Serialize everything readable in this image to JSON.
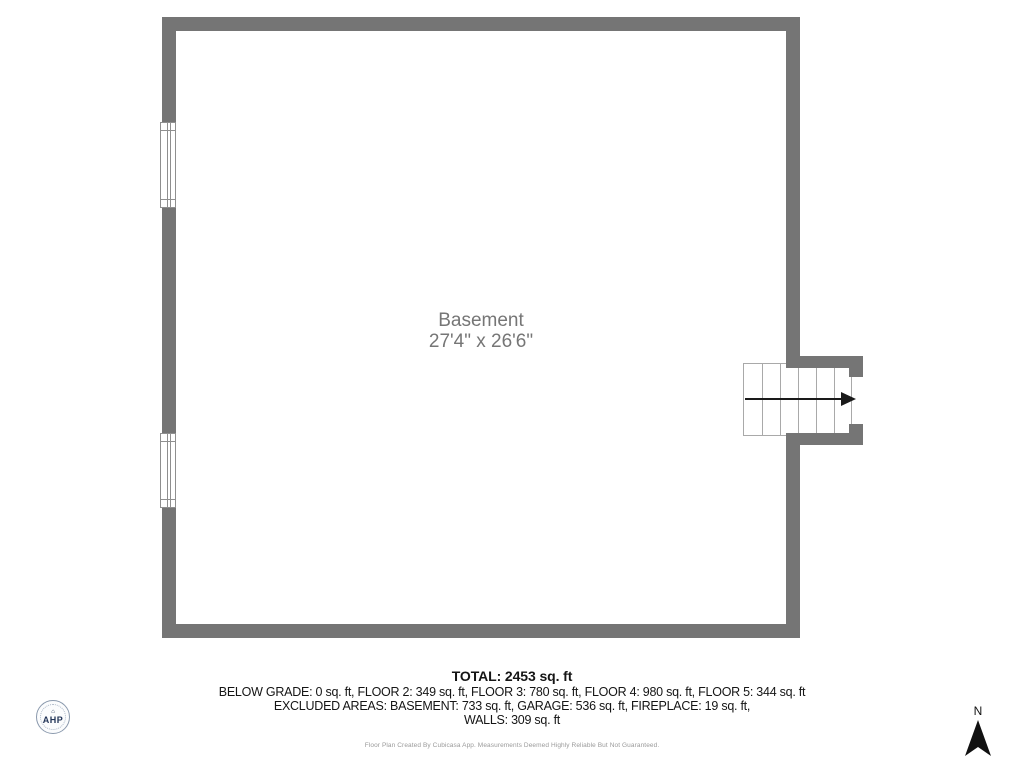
{
  "floor_plan": {
    "room": {
      "name": "Basement",
      "dimensions": "27'4\" x 26'6\""
    },
    "colors": {
      "wall": "#757575",
      "room_label": "#767676",
      "stair_outline": "#a9a9a9",
      "window_outline": "#8f8f8f",
      "arrow": "#1a1a1a"
    }
  },
  "summary": {
    "total": "TOTAL: 2453 sq. ft",
    "floors": "BELOW GRADE: 0 sq. ft, FLOOR 2: 349 sq. ft, FLOOR 3: 780 sq. ft, FLOOR 4: 980 sq. ft, FLOOR 5: 344 sq. ft",
    "excluded": "EXCLUDED AREAS: BASEMENT: 733 sq. ft, GARAGE: 536 sq. ft, FIREPLACE: 19 sq. ft,",
    "walls": "WALLS: 309 sq. ft"
  },
  "footer": {
    "disclaimer": "Floor Plan Created By Cubicasa App. Measurements Deemed Highly Reliable But Not Guaranteed."
  },
  "branding": {
    "logo_text": "AHP"
  },
  "compass": {
    "label": "N"
  }
}
